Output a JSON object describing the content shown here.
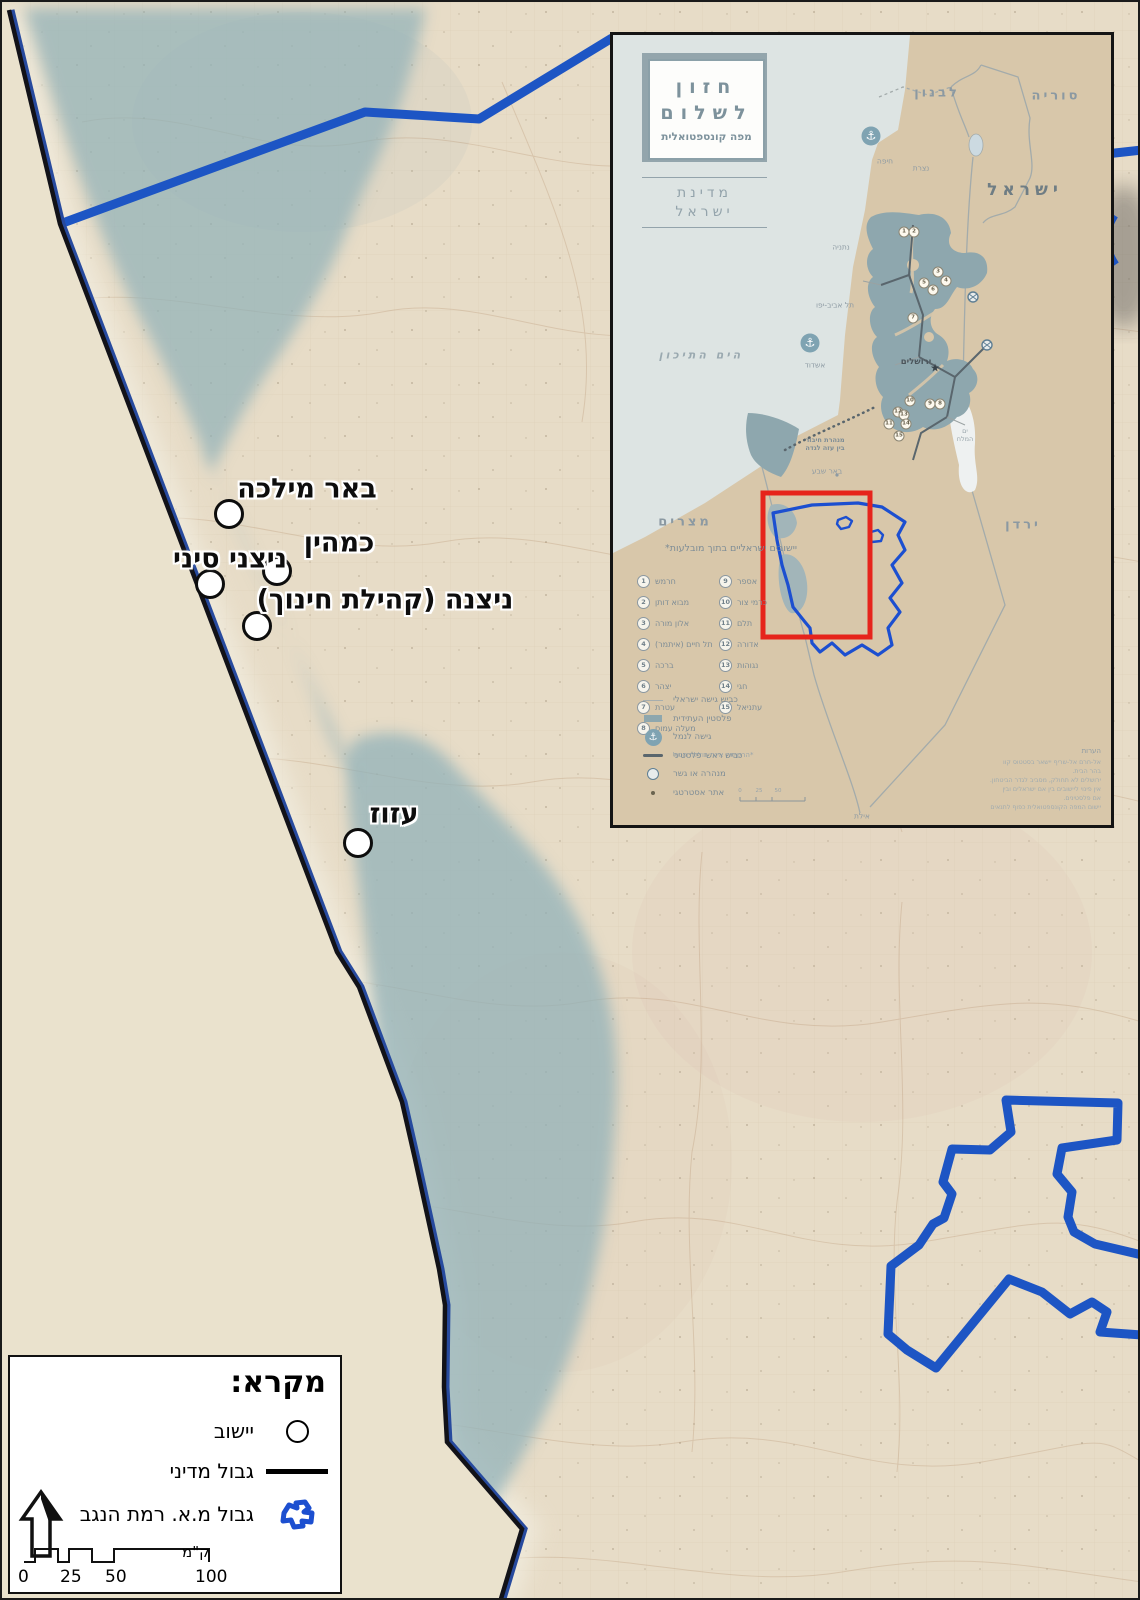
{
  "main_map": {
    "settlements": [
      {
        "name": "באר מילכה"
      },
      {
        "name": "כמהין"
      },
      {
        "name": "ניצני סיני"
      },
      {
        "name": "ניצנה (קהילת חינוך)"
      },
      {
        "name": "עזוז"
      }
    ]
  },
  "legend": {
    "title": "מקרא:",
    "items": [
      {
        "label": "יישוב",
        "symbol": "settlement-circle"
      },
      {
        "label": "גבול מדיני",
        "symbol": "black-line"
      },
      {
        "label": "גבול מ.א. רמת הנגב",
        "symbol": "blue-boundary"
      }
    ],
    "scale_ticks": [
      "0",
      "25",
      "50",
      "100"
    ],
    "scale_unit": "ק\"מ"
  },
  "inset": {
    "title_line1": "חזון",
    "title_line2": "לשלום",
    "subtitle": "מפה קונספטואלית",
    "state_label_line1": "מדינת",
    "state_label_line2": "ישראל",
    "labels": {
      "lebanon": "לבנון",
      "syria": "סוריה",
      "israel": "ישראל",
      "egypt": "מצרים",
      "jordan": "ירדן",
      "mediterranean": "הים התיכון",
      "dead_sea_line1": "ים",
      "dead_sea_line2": "המלח"
    },
    "cities": [
      {
        "name": "חיפה"
      },
      {
        "name": "נצרת"
      },
      {
        "name": "נתניה"
      },
      {
        "name": "תל אביב-יפו"
      },
      {
        "name": "אשדוד"
      },
      {
        "name": "ירושלים"
      },
      {
        "name": "באר שבע"
      },
      {
        "name": "אילת"
      }
    ],
    "tunnel_label_line1": "מנהרת חיבור",
    "tunnel_label_line2": "בין עזה לגדה",
    "enclaves_header": "יישובים ישראליים בתוך מובלעות*",
    "enclaves": [
      {
        "num": "1",
        "name": "חרמש"
      },
      {
        "num": "2",
        "name": "מבוא דותן"
      },
      {
        "num": "3",
        "name": "אלון מורה"
      },
      {
        "num": "4",
        "name": "תל חיים (איתמר)"
      },
      {
        "num": "5",
        "name": "ברכה"
      },
      {
        "num": "6",
        "name": "יצהר"
      },
      {
        "num": "7",
        "name": "עטרת"
      },
      {
        "num": "8",
        "name": "מעלה עמוס"
      },
      {
        "num": "9",
        "name": "אספר"
      },
      {
        "num": "10",
        "name": "כרמי צור"
      },
      {
        "num": "11",
        "name": "תלם"
      },
      {
        "num": "12",
        "name": "אדורה"
      },
      {
        "num": "13",
        "name": "נגוהות"
      },
      {
        "num": "14",
        "name": "חגי"
      },
      {
        "num": "15",
        "name": "עתניאל"
      }
    ],
    "enclaves_footnote": "*הרשימה אינה כוללת הכול",
    "symbols": [
      {
        "label": "כביש גישה ישראלי",
        "icon": "gray-line"
      },
      {
        "label": "פלסטין העתידית",
        "icon": "teal-swatch"
      },
      {
        "label": "גישה לנמל",
        "icon": "anchor"
      },
      {
        "label": "כביש ראשי פלסטיני",
        "icon": "dark-line"
      },
      {
        "label": "מנהרה או גשר",
        "icon": "tunnel-circle"
      },
      {
        "label": "אתר אסטרטגי",
        "icon": "dot"
      }
    ],
    "notes_header": "הערות",
    "notes": [
      "אל-חרם אל-שריף יישאר בסטטוס קוו",
      "בהר הבית.",
      "ירושלים לא תחולק, מסביב לגדר הביטחון.",
      "אין פינוי ליישובים בין אם ישראלים ובין",
      "אם פלסטינים.",
      "יישום המפה הקונספטואלית כפוף לתנאים"
    ],
    "scale_ticks": [
      "0",
      "25",
      "50"
    ]
  },
  "colors": {
    "boundary_blue": "#1d55c4",
    "border_black": "#14141a",
    "palestine_teal": "#8fadb4",
    "highlight_red": "#e6241c",
    "slate": "#8ba0a9"
  }
}
